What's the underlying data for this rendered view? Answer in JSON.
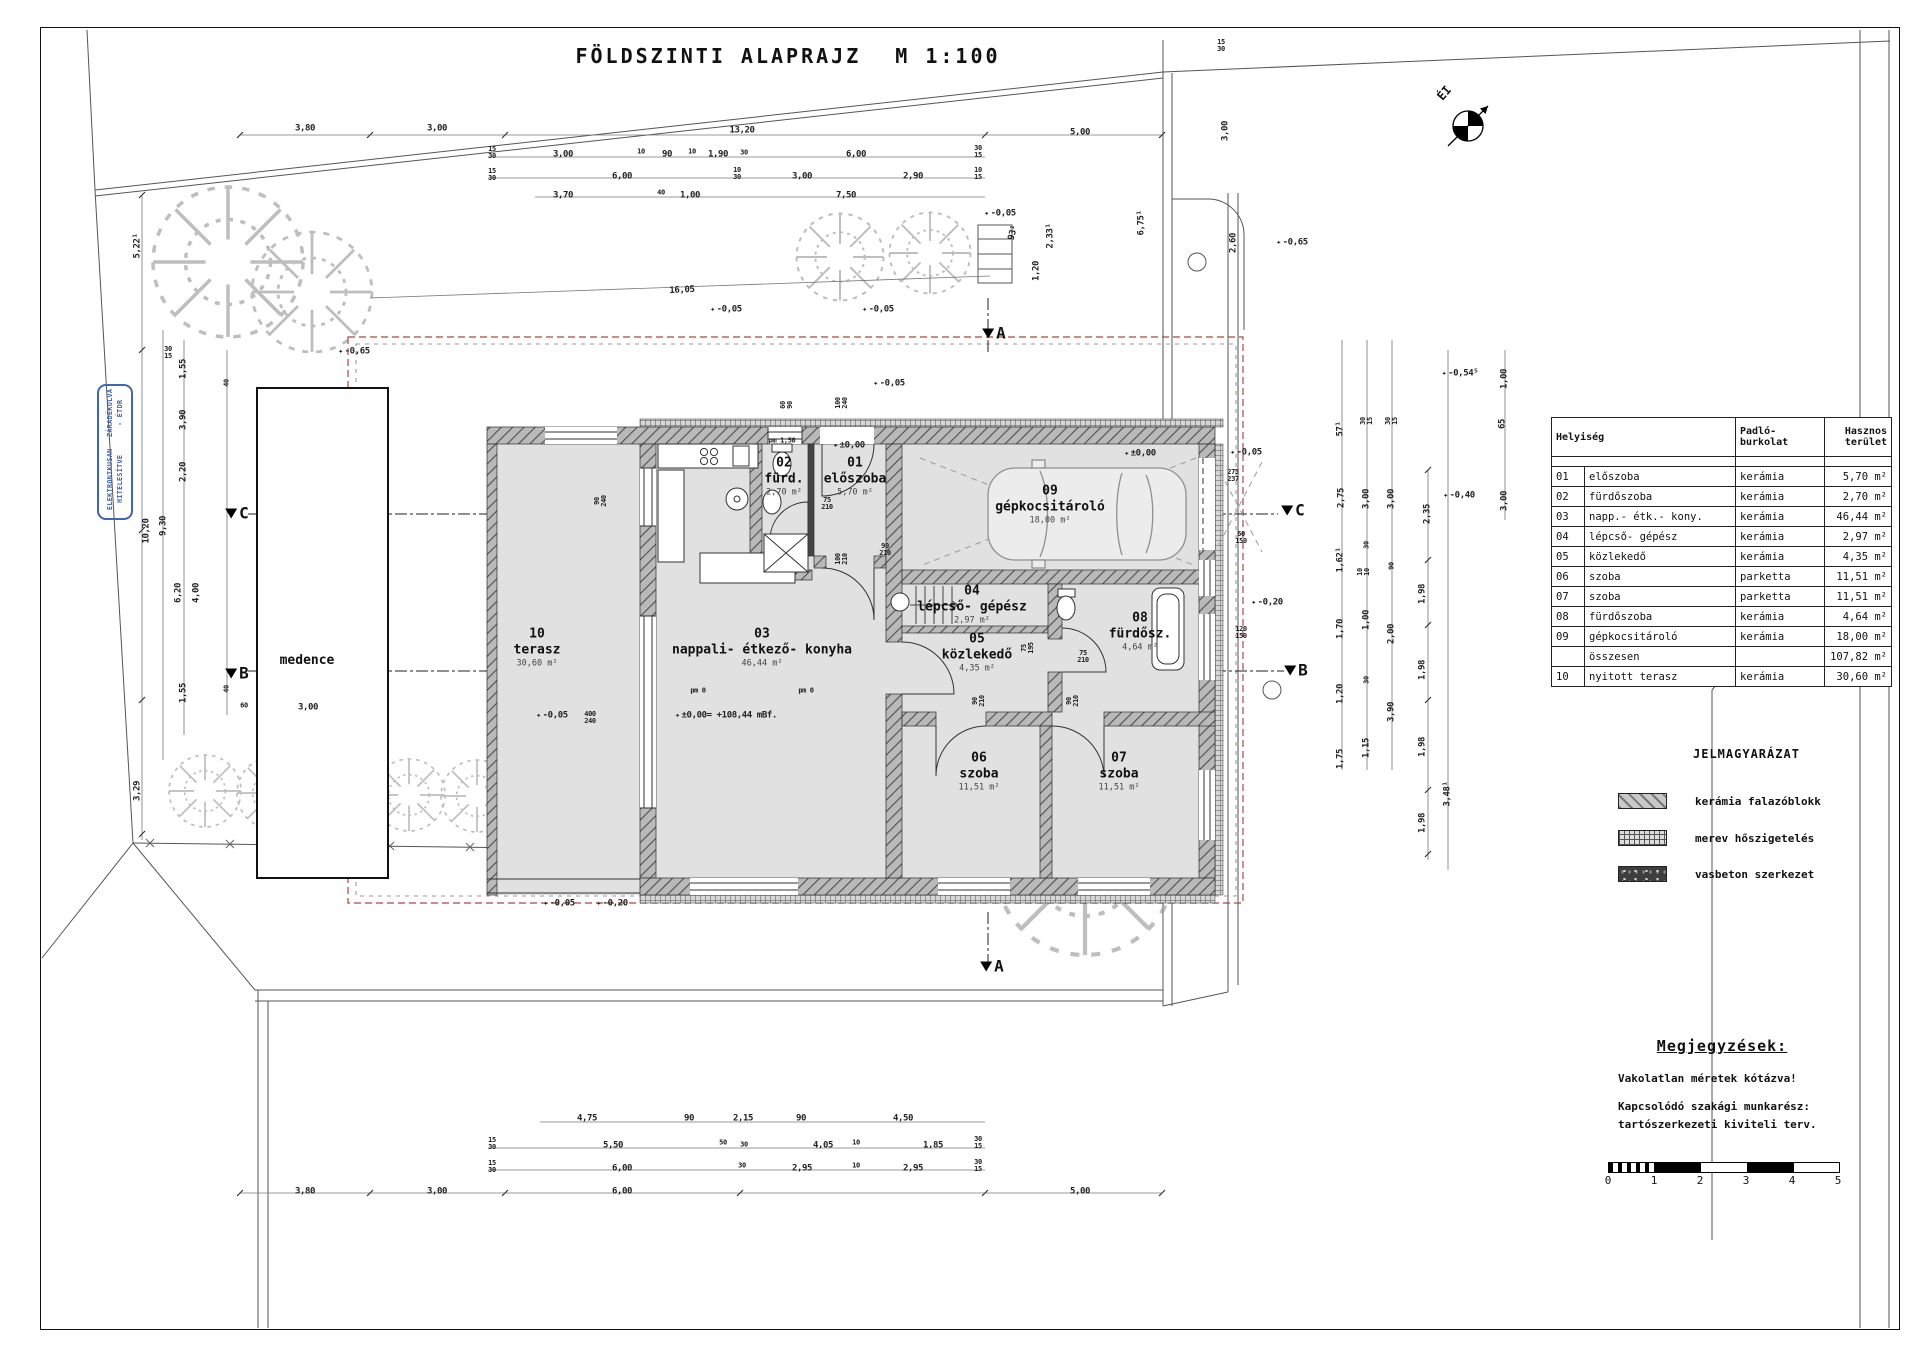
{
  "title": "FÖLDSZINTI ALAPRAJZ",
  "scale_label": "M 1:100",
  "north_label": "ÉI",
  "stamp": {
    "line1": "ELEKTRONIKUSAN HITELESÍTVE",
    "line2": "ZÁRADÉKOLVA - ÉTDR"
  },
  "rooms": [
    {
      "num": "10",
      "name": "terasz",
      "area": "30,60 m²",
      "x": 537,
      "y": 648
    },
    {
      "num": "03",
      "name": "nappali- étkező- konyha",
      "area": "46,44 m²",
      "x": 762,
      "y": 648
    },
    {
      "num": "01",
      "name": "előszoba",
      "area": "5,70 m²",
      "x": 855,
      "y": 477
    },
    {
      "num": "02",
      "name": "fürd.",
      "area": "2,70 m²",
      "x": 784,
      "y": 477
    },
    {
      "num": "09",
      "name": "gépkocsitároló",
      "area": "18,00 m²",
      "x": 1050,
      "y": 505
    },
    {
      "num": "04",
      "name": "lépcső- gépész",
      "area": "2,97 m²",
      "x": 972,
      "y": 605
    },
    {
      "num": "05",
      "name": "közlekedő",
      "area": "4,35 m²",
      "x": 977,
      "y": 653
    },
    {
      "num": "08",
      "name": "fürdősz.",
      "area": "4,64 m²",
      "x": 1140,
      "y": 632
    },
    {
      "num": "06",
      "name": "szoba",
      "area": "11,51 m²",
      "x": 979,
      "y": 772
    },
    {
      "num": "07",
      "name": "szoba",
      "area": "11,51 m²",
      "x": 1119,
      "y": 772
    },
    {
      "num": "",
      "name": "medence",
      "area": "",
      "x": 307,
      "y": 661
    }
  ],
  "section_markers": [
    {
      "t": "A",
      "x": 994,
      "y": 333
    },
    {
      "t": "A",
      "x": 992,
      "y": 966
    },
    {
      "t": "B",
      "x": 237,
      "y": 673
    },
    {
      "t": "B",
      "x": 1296,
      "y": 670
    },
    {
      "t": "C",
      "x": 237,
      "y": 513
    },
    {
      "t": "C",
      "x": 1293,
      "y": 510
    }
  ],
  "dims": [
    {
      "t": "3,80",
      "x": 305,
      "y": 129
    },
    {
      "t": "3,00",
      "x": 437,
      "y": 129
    },
    {
      "t": "13,20",
      "x": 742,
      "y": 131
    },
    {
      "t": "5,00",
      "x": 1080,
      "y": 133
    },
    {
      "t": "15\n30",
      "x": 492,
      "y": 153,
      "cls": "s"
    },
    {
      "t": "3,00",
      "x": 563,
      "y": 155
    },
    {
      "t": "10",
      "x": 641,
      "y": 152,
      "cls": "s"
    },
    {
      "t": "90",
      "x": 667,
      "y": 155
    },
    {
      "t": "10",
      "x": 692,
      "y": 152,
      "cls": "s"
    },
    {
      "t": "1,90",
      "x": 718,
      "y": 155
    },
    {
      "t": "30",
      "x": 744,
      "y": 153,
      "cls": "s"
    },
    {
      "t": "6,00",
      "x": 856,
      "y": 155
    },
    {
      "t": "30\n15",
      "x": 978,
      "y": 152,
      "cls": "s"
    },
    {
      "t": "15\n30",
      "x": 492,
      "y": 175,
      "cls": "s"
    },
    {
      "t": "6,00",
      "x": 622,
      "y": 177
    },
    {
      "t": "10\n30",
      "x": 737,
      "y": 174,
      "cls": "s"
    },
    {
      "t": "3,00",
      "x": 802,
      "y": 177
    },
    {
      "t": "2,90",
      "x": 913,
      "y": 177
    },
    {
      "t": "10\n15",
      "x": 978,
      "y": 174,
      "cls": "s"
    },
    {
      "t": "3,70",
      "x": 563,
      "y": 196
    },
    {
      "t": "40",
      "x": 661,
      "y": 193,
      "cls": "s"
    },
    {
      "t": "1,00",
      "x": 690,
      "y": 196
    },
    {
      "t": "7,50",
      "x": 846,
      "y": 196
    },
    {
      "t": "16,05",
      "x": 682,
      "y": 291,
      "r": -3
    },
    {
      "t": "-0,05",
      "x": 726,
      "y": 310,
      "cls": "lv"
    },
    {
      "t": "-0,05",
      "x": 878,
      "y": 310,
      "cls": "lv"
    },
    {
      "t": "-0,05",
      "x": 1000,
      "y": 214,
      "cls": "lv"
    },
    {
      "t": "93¹",
      "x": 1014,
      "y": 233,
      "r": -75
    },
    {
      "t": "1,20",
      "x": 1037,
      "y": 271,
      "r": -90
    },
    {
      "t": "2,33¹",
      "x": 1051,
      "y": 236,
      "r": -90
    },
    {
      "t": "6,75¹",
      "x": 1142,
      "y": 223,
      "r": -90
    },
    {
      "t": "-0,65",
      "x": 1292,
      "y": 243,
      "cls": "lv"
    },
    {
      "t": "3,00",
      "x": 1226,
      "y": 131,
      "r": -90
    },
    {
      "t": "2,60",
      "x": 1234,
      "y": 243,
      "r": -90
    },
    {
      "t": "15\n30",
      "x": 1221,
      "y": 46,
      "cls": "s"
    },
    {
      "t": "60\n90",
      "x": 787,
      "y": 405,
      "r": -90,
      "cls": "s"
    },
    {
      "t": "100\n240",
      "x": 842,
      "y": 403,
      "r": -90,
      "cls": "s"
    },
    {
      "t": "pm 1,50",
      "x": 782,
      "y": 441,
      "cls": "s"
    },
    {
      "t": "±0,00",
      "x": 849,
      "y": 446,
      "cls": "lv"
    },
    {
      "t": "-0,05",
      "x": 889,
      "y": 384,
      "cls": "lv"
    },
    {
      "t": "75\n210",
      "x": 827,
      "y": 504,
      "cls": "s"
    },
    {
      "t": "90\n210",
      "x": 885,
      "y": 550,
      "cls": "s"
    },
    {
      "t": "100\n210",
      "x": 842,
      "y": 559,
      "r": -90,
      "cls": "s"
    },
    {
      "t": "75\n195",
      "x": 1028,
      "y": 648,
      "r": -90,
      "cls": "s"
    },
    {
      "t": "75\n210",
      "x": 1083,
      "y": 657,
      "cls": "s"
    },
    {
      "t": "90\n210",
      "x": 979,
      "y": 701,
      "r": -90,
      "cls": "s"
    },
    {
      "t": "90\n210",
      "x": 1073,
      "y": 701,
      "r": -90,
      "cls": "s"
    },
    {
      "t": "90\n240",
      "x": 601,
      "y": 501,
      "r": -90,
      "cls": "s"
    },
    {
      "t": "400\n240",
      "x": 590,
      "y": 718,
      "cls": "s"
    },
    {
      "t": "-0,05",
      "x": 552,
      "y": 716,
      "cls": "lv"
    },
    {
      "t": "±0,00= +108,44 mBf.",
      "x": 726,
      "y": 716,
      "cls": "lv"
    },
    {
      "t": "pm 0",
      "x": 698,
      "y": 691,
      "cls": "s"
    },
    {
      "t": "pm 0",
      "x": 806,
      "y": 691,
      "cls": "s"
    },
    {
      "t": "±0,00",
      "x": 1140,
      "y": 454,
      "cls": "lv"
    },
    {
      "t": "-0,05",
      "x": 1246,
      "y": 453,
      "cls": "lv"
    },
    {
      "t": "275\n237",
      "x": 1233,
      "y": 476,
      "cls": "s"
    },
    {
      "t": "60\n150",
      "x": 1241,
      "y": 538,
      "cls": "s"
    },
    {
      "t": "120\n150",
      "x": 1241,
      "y": 633,
      "cls": "s"
    },
    {
      "t": "-0,05",
      "x": 559,
      "y": 904,
      "cls": "lv"
    },
    {
      "t": "-0,20",
      "x": 612,
      "y": 904,
      "cls": "lv"
    },
    {
      "t": "-0,20",
      "x": 1267,
      "y": 603,
      "cls": "lv"
    },
    {
      "t": "-0,54⁵",
      "x": 1460,
      "y": 374,
      "cls": "lv"
    },
    {
      "t": "-0,40",
      "x": 1459,
      "y": 496,
      "cls": "lv"
    },
    {
      "t": "1,00",
      "x": 1505,
      "y": 379,
      "r": -90
    },
    {
      "t": "65",
      "x": 1503,
      "y": 424,
      "r": -90
    },
    {
      "t": "3,00",
      "x": 1505,
      "y": 501,
      "r": -90
    },
    {
      "t": "57¹",
      "x": 1341,
      "y": 429,
      "r": -90
    },
    {
      "t": "30\n15",
      "x": 1367,
      "y": 421,
      "r": -90,
      "cls": "s"
    },
    {
      "t": "30\n15",
      "x": 1392,
      "y": 421,
      "r": -90,
      "cls": "s"
    },
    {
      "t": "2,75",
      "x": 1342,
      "y": 498,
      "r": -90
    },
    {
      "t": "3,00",
      "x": 1367,
      "y": 499,
      "r": -90
    },
    {
      "t": "3,00",
      "x": 1392,
      "y": 499,
      "r": -90
    },
    {
      "t": "1,62¹",
      "x": 1341,
      "y": 560,
      "r": -90
    },
    {
      "t": "30",
      "x": 1367,
      "y": 545,
      "r": -90,
      "cls": "s"
    },
    {
      "t": "10\n10",
      "x": 1364,
      "y": 572,
      "r": -90,
      "cls": "s"
    },
    {
      "t": "90",
      "x": 1392,
      "y": 566,
      "r": -90,
      "cls": "s"
    },
    {
      "t": "1,70",
      "x": 1341,
      "y": 629,
      "r": -90
    },
    {
      "t": "1,00",
      "x": 1367,
      "y": 620,
      "r": -90
    },
    {
      "t": "2,00",
      "x": 1392,
      "y": 634,
      "r": -90
    },
    {
      "t": "1,20",
      "x": 1341,
      "y": 694,
      "r": -90
    },
    {
      "t": "30",
      "x": 1367,
      "y": 680,
      "r": -90,
      "cls": "s"
    },
    {
      "t": "3,90",
      "x": 1392,
      "y": 712,
      "r": -90
    },
    {
      "t": "1,75",
      "x": 1341,
      "y": 759,
      "r": -90
    },
    {
      "t": "1,15",
      "x": 1367,
      "y": 748,
      "r": -90
    },
    {
      "t": "2,35",
      "x": 1428,
      "y": 514,
      "r": -90
    },
    {
      "t": "1,98",
      "x": 1423,
      "y": 594,
      "r": -90
    },
    {
      "t": "1,98",
      "x": 1423,
      "y": 670,
      "r": -90
    },
    {
      "t": "1,98",
      "x": 1423,
      "y": 747,
      "r": -90
    },
    {
      "t": "1,98",
      "x": 1423,
      "y": 823,
      "r": -90
    },
    {
      "t": "3,48¹",
      "x": 1448,
      "y": 794,
      "r": -90
    },
    {
      "t": "5,22¹",
      "x": 138,
      "y": 246,
      "r": -90
    },
    {
      "t": "30\n15",
      "x": 168,
      "y": 353,
      "cls": "s"
    },
    {
      "t": "1,55",
      "x": 184,
      "y": 369,
      "r": -90
    },
    {
      "t": "3,90",
      "x": 184,
      "y": 420,
      "r": -90
    },
    {
      "t": "2,20",
      "x": 184,
      "y": 472,
      "r": -90
    },
    {
      "t": "10,20",
      "x": 147,
      "y": 531,
      "r": -90
    },
    {
      "t": "9,30",
      "x": 164,
      "y": 526,
      "r": -90
    },
    {
      "t": "6,20",
      "x": 179,
      "y": 593,
      "r": -90
    },
    {
      "t": "4,00",
      "x": 197,
      "y": 593,
      "r": -90
    },
    {
      "t": "1,55",
      "x": 184,
      "y": 693,
      "r": -90
    },
    {
      "t": "3,29",
      "x": 138,
      "y": 791,
      "r": -90
    },
    {
      "t": "40",
      "x": 227,
      "y": 383,
      "r": -90,
      "cls": "s"
    },
    {
      "t": "40",
      "x": 227,
      "y": 689,
      "r": -90,
      "cls": "s"
    },
    {
      "t": "60",
      "x": 244,
      "y": 706,
      "cls": "s"
    },
    {
      "t": "3,00",
      "x": 308,
      "y": 708
    },
    {
      "t": "-0,65",
      "x": 354,
      "y": 352,
      "cls": "lv"
    },
    {
      "t": "4,75",
      "x": 587,
      "y": 1119
    },
    {
      "t": "90",
      "x": 689,
      "y": 1119
    },
    {
      "t": "2,15",
      "x": 743,
      "y": 1119
    },
    {
      "t": "90",
      "x": 801,
      "y": 1119
    },
    {
      "t": "4,50",
      "x": 903,
      "y": 1119
    },
    {
      "t": "15\n30",
      "x": 492,
      "y": 1144,
      "cls": "s"
    },
    {
      "t": "5,50",
      "x": 613,
      "y": 1146
    },
    {
      "t": "50",
      "x": 723,
      "y": 1143,
      "cls": "s"
    },
    {
      "t": "30",
      "x": 744,
      "y": 1145,
      "cls": "s"
    },
    {
      "t": "4,05",
      "x": 823,
      "y": 1146
    },
    {
      "t": "10",
      "x": 856,
      "y": 1143,
      "cls": "s"
    },
    {
      "t": "1,85",
      "x": 933,
      "y": 1146
    },
    {
      "t": "30\n15",
      "x": 978,
      "y": 1143,
      "cls": "s"
    },
    {
      "t": "15\n30",
      "x": 492,
      "y": 1167,
      "cls": "s"
    },
    {
      "t": "6,00",
      "x": 622,
      "y": 1169
    },
    {
      "t": "30",
      "x": 742,
      "y": 1166,
      "cls": "s"
    },
    {
      "t": "2,95",
      "x": 802,
      "y": 1169
    },
    {
      "t": "10",
      "x": 856,
      "y": 1166,
      "cls": "s"
    },
    {
      "t": "2,95",
      "x": 913,
      "y": 1169
    },
    {
      "t": "30\n15",
      "x": 978,
      "y": 1166,
      "cls": "s"
    },
    {
      "t": "3,80",
      "x": 305,
      "y": 1192
    },
    {
      "t": "3,00",
      "x": 437,
      "y": 1192
    },
    {
      "t": "6,00",
      "x": 622,
      "y": 1192
    },
    {
      "t": "5,00",
      "x": 1080,
      "y": 1192
    }
  ],
  "table": {
    "header": {
      "room": "Helyiség",
      "floor": "Padló-\nburkolat",
      "area": "Hasznos\nterület"
    },
    "rows": [
      {
        "no": "01",
        "name": "előszoba",
        "floor": "kerámia",
        "area": "5,70 m²"
      },
      {
        "no": "02",
        "name": "fürdőszoba",
        "floor": "kerámia",
        "area": "2,70 m²"
      },
      {
        "no": "03",
        "name": "napp.- étk.- kony.",
        "floor": "kerámia",
        "area": "46,44 m²"
      },
      {
        "no": "04",
        "name": "lépcső- gépész",
        "floor": "kerámia",
        "area": "2,97 m²"
      },
      {
        "no": "05",
        "name": "közlekedő",
        "floor": "kerámia",
        "area": "4,35 m²"
      },
      {
        "no": "06",
        "name": "szoba",
        "floor": "parketta",
        "area": "11,51 m²"
      },
      {
        "no": "07",
        "name": "szoba",
        "floor": "parketta",
        "area": "11,51 m²"
      },
      {
        "no": "08",
        "name": "fürdőszoba",
        "floor": "kerámia",
        "area": "4,64 m²"
      },
      {
        "no": "09",
        "name": "gépkocsitároló",
        "floor": "kerámia",
        "area": "18,00 m²"
      },
      {
        "no": "",
        "name": "összesen",
        "floor": "",
        "area": "107,82 m²",
        "cls": "total"
      },
      {
        "no": "10",
        "name": "nyitott terasz",
        "floor": "kerámia",
        "area": "30,60 m²"
      }
    ]
  },
  "legend": {
    "title": "JELMAGYARÁZAT",
    "items": [
      {
        "label": "kerámia falazóblokk"
      },
      {
        "label": "merev hőszigetelés"
      },
      {
        "label": "vasbeton szerkezet"
      }
    ]
  },
  "notes": {
    "title": "Megjegyzések:",
    "lines": [
      "Vakolatlan méretek kótázva!",
      "Kapcsolódó szakági munkarész:",
      "tartószerkezeti kiviteli terv."
    ]
  },
  "scalebar": {
    "labels": [
      "0",
      "1",
      "2",
      "3",
      "4",
      "5"
    ]
  }
}
